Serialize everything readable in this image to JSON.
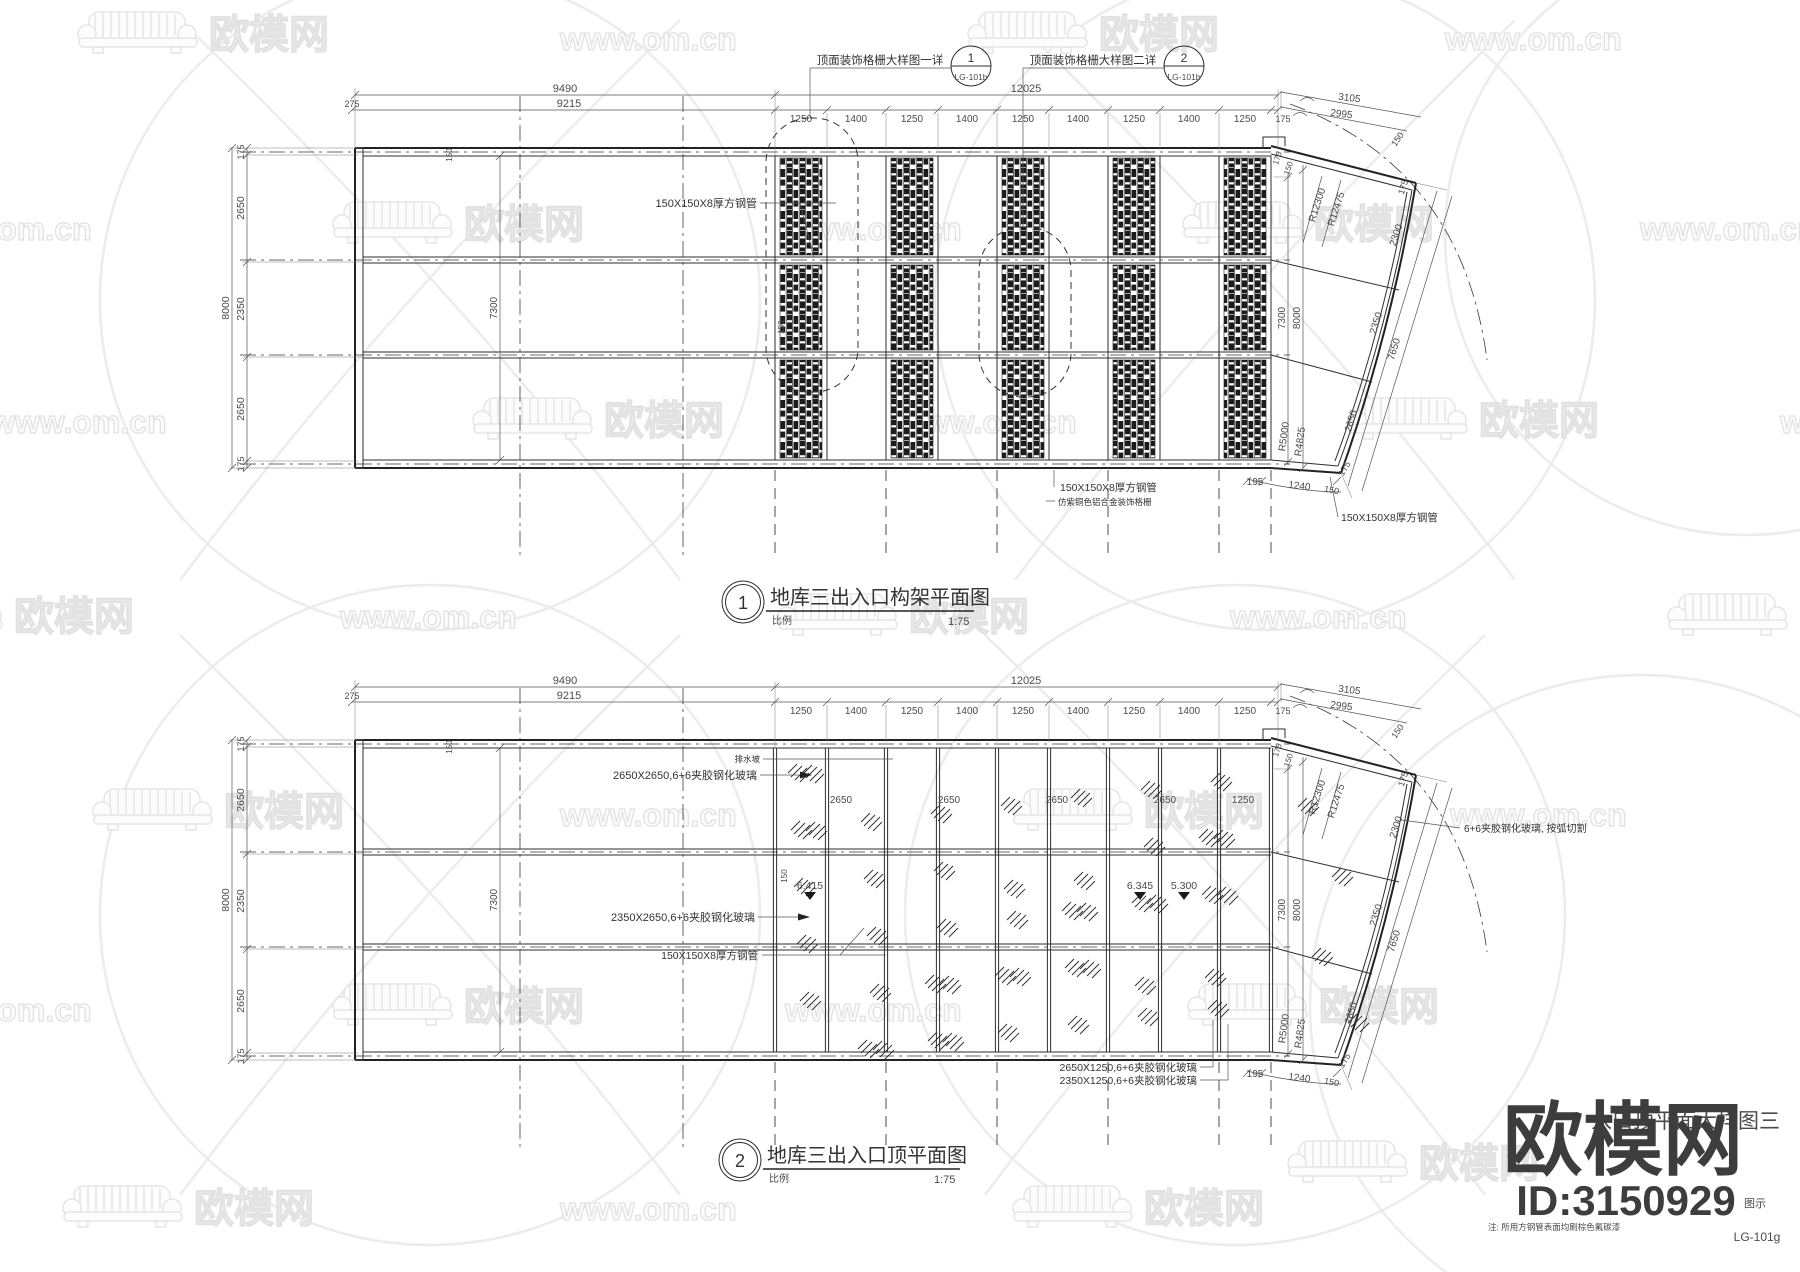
{
  "watermark": {
    "brand": "欧模网",
    "url": "www.om.cn",
    "tiles": [
      {
        "t": "logo",
        "x": 75,
        "y": 6
      },
      {
        "t": "url",
        "x": 560,
        "y": 22
      },
      {
        "t": "logo",
        "x": 965,
        "y": 6
      },
      {
        "t": "url",
        "x": 1445,
        "y": 22
      },
      {
        "t": "url",
        "x": -85,
        "y": 212
      },
      {
        "t": "logo",
        "x": 330,
        "y": 196
      },
      {
        "t": "url",
        "x": 785,
        "y": 212
      },
      {
        "t": "logo",
        "x": 1180,
        "y": 196
      },
      {
        "t": "url",
        "x": 1640,
        "y": 212
      },
      {
        "t": "url",
        "x": -10,
        "y": 405
      },
      {
        "t": "logo",
        "x": 470,
        "y": 392
      },
      {
        "t": "url",
        "x": 900,
        "y": 405
      },
      {
        "t": "logo",
        "x": 1345,
        "y": 392
      },
      {
        "t": "url",
        "x": 1780,
        "y": 405
      },
      {
        "t": "logo",
        "x": -120,
        "y": 588
      },
      {
        "t": "url",
        "x": 340,
        "y": 600
      },
      {
        "t": "logo",
        "x": 775,
        "y": 588
      },
      {
        "t": "url",
        "x": 1230,
        "y": 600
      },
      {
        "t": "logo",
        "x": 1665,
        "y": 588
      },
      {
        "t": "logo",
        "x": 90,
        "y": 783
      },
      {
        "t": "url",
        "x": 560,
        "y": 798
      },
      {
        "t": "logo",
        "x": 1010,
        "y": 783
      },
      {
        "t": "url",
        "x": 1450,
        "y": 798
      },
      {
        "t": "url",
        "x": -85,
        "y": 993
      },
      {
        "t": "logo",
        "x": 330,
        "y": 978
      },
      {
        "t": "url",
        "x": 785,
        "y": 993
      },
      {
        "t": "logo",
        "x": 1185,
        "y": 978
      },
      {
        "t": "logo",
        "x": 1285,
        "y": 1135
      },
      {
        "t": "logo",
        "x": 60,
        "y": 1180
      },
      {
        "t": "url",
        "x": 560,
        "y": 1192
      },
      {
        "t": "logo",
        "x": 1010,
        "y": 1180
      }
    ]
  },
  "corner": {
    "brand": "欧模网",
    "id": "ID:3150929",
    "legend_label": "图示",
    "sheet_no": "LG-101g",
    "note": "注: 所用方钢管表面均刷棕色氟碳漆",
    "obscured_title": "入口顶平面大样图三"
  },
  "dims": {
    "top_total": "9490",
    "top_inner": "9215",
    "left_offset": "275",
    "mid_total": "12025",
    "segs": [
      "1250",
      "1400",
      "1250",
      "1400",
      "1250",
      "1400",
      "1250",
      "1400",
      "1250",
      "175"
    ],
    "left_chain": [
      "175",
      "2650",
      "2350",
      "2650",
      "175"
    ],
    "left_total": "8000",
    "inner_height": "7300",
    "right_inner": "7300",
    "right_total": "8000",
    "arc_outer": "3105",
    "arc_inner": "2995",
    "arc_end": "150",
    "radius_outer": "R12300",
    "radius_inner": "R12475",
    "fan_width": "2300",
    "fan_step_a": "175",
    "fan_step_b": "150",
    "fan_edge": "175",
    "incl_a": "2350",
    "incl_b": "7650",
    "incl_c": "2650",
    "radius_small_a": "R5000",
    "radius_small_b": "R4825",
    "fan_end": "175",
    "bot_a": "195",
    "bot_b": "1240",
    "bot_c": "150",
    "cap_w": "150"
  },
  "plan1": {
    "num": "1",
    "title": "地库三出入口构架平面图",
    "scale_label": "比例",
    "scale": "1:75",
    "callout1": {
      "text": "顶面装饰格栅大样图一详",
      "num": "1",
      "ref": "LG-101b"
    },
    "callout2": {
      "text": "顶面装饰格栅大样图二详",
      "num": "2",
      "ref": "LG-101b"
    },
    "tube_label": "150X150X8厚方钢管",
    "tube_label2": "150X150X8厚方钢管",
    "tube_label3": "150X150X8厚方钢管",
    "grille_label": "仿紫铜色铝合金装饰格栅",
    "joint_dim": "150"
  },
  "plan2": {
    "num": "2",
    "title": "地库三出入口顶平面图",
    "scale_label": "比例",
    "scale": "1:75",
    "glass_a": "2650X2650,6+6夹胶钢化玻璃",
    "glass_b": "2350X2650,6+6夹胶钢化玻璃",
    "glass_c": "2650X1250,6+6夹胶钢化玻璃",
    "glass_d": "2350X1250,6+6夹胶钢化玻璃",
    "glass_arc": "6+6夹胶钢化玻璃, 按弧切割",
    "tube_label": "150X150X8厚方钢管",
    "drain_label": "排水坡",
    "panel_dims": [
      "2650",
      "2650",
      "2650",
      "2650",
      "1250"
    ],
    "elevations": [
      "6.415",
      "6.345",
      "5.300"
    ],
    "joint_dim": "150"
  }
}
